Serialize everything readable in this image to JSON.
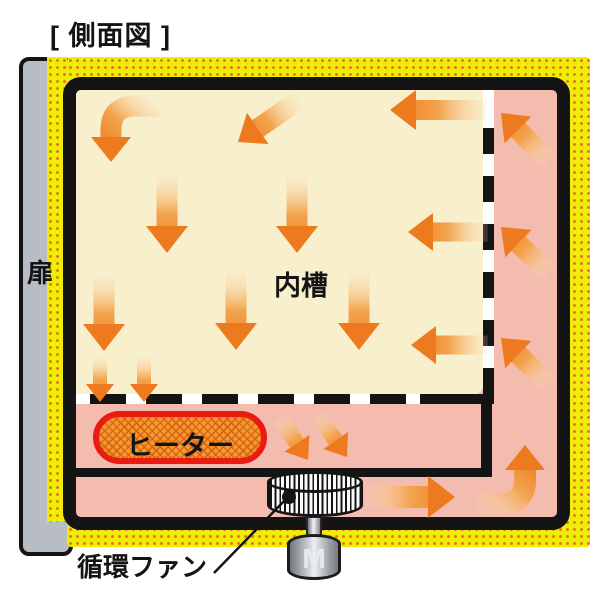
{
  "title": "[ 側面図 ]",
  "labels": {
    "door": "扉",
    "inner_chamber": "内槽",
    "heater": "ヒーター",
    "fan": "循環ファン",
    "motor": "M"
  },
  "colors": {
    "insulation_yellow": "#EDED05",
    "insulation_dot": "#E8751A",
    "duct_pink": "#F4BCAE",
    "chamber_cream": "#F8EFCD",
    "outline_black": "#141414",
    "door_gray": "#B7BDC3",
    "heater_fill": "#F29B2E",
    "heater_border": "#EA1C12",
    "arrow_head": "#ED7A1F",
    "arrow_mid": "#F3A44E",
    "arrow_tail": "#FBDFB4"
  },
  "airflow_arrows": [
    {
      "name": "chamber-curve-down-topleft",
      "from": [
        160,
        106
      ],
      "via": [
        111,
        106
      ],
      "to": [
        111,
        162
      ],
      "shaft": 21,
      "head_w": 40,
      "head_l": 25
    },
    {
      "name": "chamber-diagonal-left-top",
      "from": [
        299,
        100
      ],
      "to": [
        238,
        142
      ],
      "shaft": 20,
      "head_w": 38,
      "head_l": 24
    },
    {
      "name": "chamber-left-topright",
      "from": [
        488,
        110
      ],
      "to": [
        390,
        110
      ],
      "shaft": 20,
      "head_w": 40,
      "head_l": 26
    },
    {
      "name": "chamber-down-1",
      "from": [
        167,
        175
      ],
      "to": [
        167,
        253
      ],
      "shaft": 21,
      "head_w": 42,
      "head_l": 27
    },
    {
      "name": "chamber-down-2",
      "from": [
        297,
        176
      ],
      "to": [
        297,
        253
      ],
      "shaft": 21,
      "head_w": 42,
      "head_l": 27
    },
    {
      "name": "chamber-down-3",
      "from": [
        104,
        276
      ],
      "to": [
        104,
        351
      ],
      "shaft": 21,
      "head_w": 42,
      "head_l": 27
    },
    {
      "name": "chamber-down-4",
      "from": [
        236,
        272
      ],
      "to": [
        236,
        350
      ],
      "shaft": 21,
      "head_w": 42,
      "head_l": 27
    },
    {
      "name": "chamber-down-5",
      "from": [
        359,
        272
      ],
      "to": [
        359,
        350
      ],
      "shaft": 21,
      "head_w": 42,
      "head_l": 27
    },
    {
      "name": "chamber-left-midright",
      "from": [
        488,
        232
      ],
      "to": [
        408,
        232
      ],
      "shaft": 19,
      "head_w": 38,
      "head_l": 25
    },
    {
      "name": "chamber-left-lowright",
      "from": [
        488,
        345
      ],
      "to": [
        411,
        345
      ],
      "shaft": 19,
      "head_w": 38,
      "head_l": 25
    },
    {
      "name": "floor-down-small-1",
      "from": [
        100,
        357
      ],
      "to": [
        100,
        402
      ],
      "shaft": 14,
      "head_w": 28,
      "head_l": 18
    },
    {
      "name": "floor-down-small-2",
      "from": [
        144,
        357
      ],
      "to": [
        144,
        402
      ],
      "shaft": 14,
      "head_w": 28,
      "head_l": 18
    },
    {
      "name": "heater-to-fan-1",
      "from": [
        280,
        418
      ],
      "to": [
        308,
        460
      ],
      "shaft": 16,
      "head_w": 30,
      "head_l": 20
    },
    {
      "name": "heater-to-fan-2",
      "from": [
        318,
        415
      ],
      "to": [
        347,
        457
      ],
      "shaft": 16,
      "head_w": 30,
      "head_l": 20
    },
    {
      "name": "duct-bottom-right",
      "from": [
        366,
        497
      ],
      "to": [
        455,
        497
      ],
      "shaft": 22,
      "head_w": 42,
      "head_l": 27
    },
    {
      "name": "duct-corner-up",
      "from": [
        476,
        504
      ],
      "via": [
        525,
        504
      ],
      "to": [
        525,
        445
      ],
      "shaft": 22,
      "head_w": 40,
      "head_l": 25
    },
    {
      "name": "duct-right-up-1",
      "from": [
        549,
        161
      ],
      "to": [
        501,
        113
      ],
      "shaft": 20,
      "head_w": 38,
      "head_l": 24
    },
    {
      "name": "duct-right-up-2",
      "from": [
        549,
        273
      ],
      "to": [
        501,
        227
      ],
      "shaft": 20,
      "head_w": 38,
      "head_l": 24
    },
    {
      "name": "duct-right-up-3",
      "from": [
        549,
        384
      ],
      "to": [
        501,
        338
      ],
      "shaft": 20,
      "head_w": 38,
      "head_l": 24
    }
  ],
  "callout": {
    "line_from": [
      288,
      497
    ],
    "line_to": [
      214,
      573
    ]
  }
}
